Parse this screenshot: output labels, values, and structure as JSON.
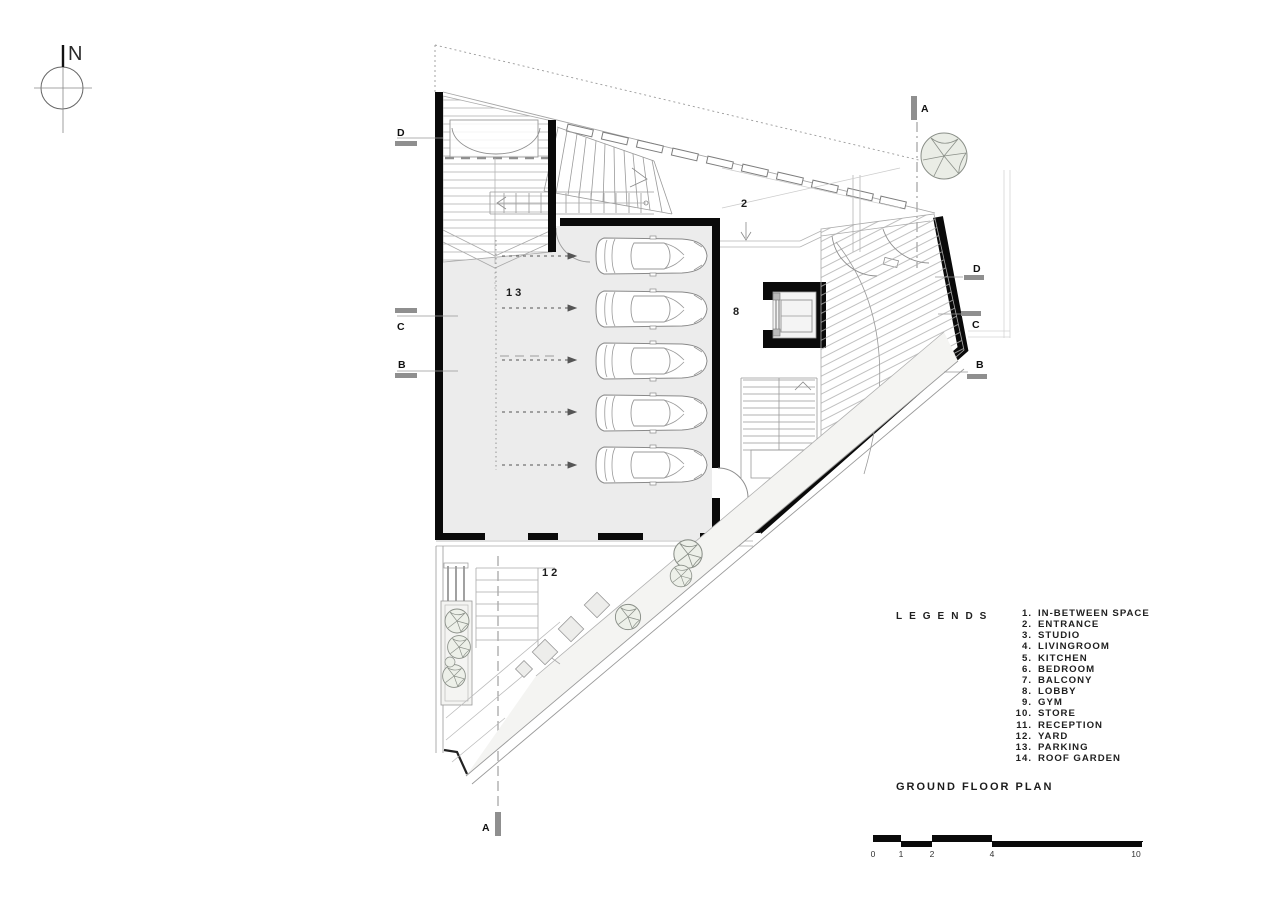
{
  "compass": {
    "north": "N"
  },
  "plan": {
    "labels": {
      "entrance": "2",
      "parking": "13",
      "lobby": "8",
      "yard": "12"
    },
    "markers": {
      "a": "A",
      "b": "B",
      "c": "C",
      "d": "D"
    }
  },
  "legend": {
    "heading": "LEGENDS",
    "items": [
      {
        "n": "1.",
        "t": "IN-BETWEEN SPACE"
      },
      {
        "n": "2.",
        "t": "ENTRANCE"
      },
      {
        "n": "3.",
        "t": "STUDIO"
      },
      {
        "n": "4.",
        "t": "LIVINGROOM"
      },
      {
        "n": "5.",
        "t": "KITCHEN"
      },
      {
        "n": "6.",
        "t": "BEDROOM"
      },
      {
        "n": "7.",
        "t": "BALCONY"
      },
      {
        "n": "8.",
        "t": "LOBBY"
      },
      {
        "n": "9.",
        "t": "GYM"
      },
      {
        "n": "10.",
        "t": "STORE"
      },
      {
        "n": "11.",
        "t": "RECEPTION"
      },
      {
        "n": "12.",
        "t": "YARD"
      },
      {
        "n": "13.",
        "t": "PARKING"
      },
      {
        "n": "14.",
        "t": "ROOF GARDEN"
      }
    ]
  },
  "titles": {
    "plan_title": "GROUND FLOOR PLAN"
  },
  "scale_bar": {
    "ticks": [
      "0",
      "1",
      "2",
      "4",
      "10"
    ]
  },
  "colors": {
    "wall": "#0a0a0a",
    "hatch": "#b3b3b3",
    "floor_fill": "#ececec",
    "marker_bar": "#8f8f8f"
  }
}
